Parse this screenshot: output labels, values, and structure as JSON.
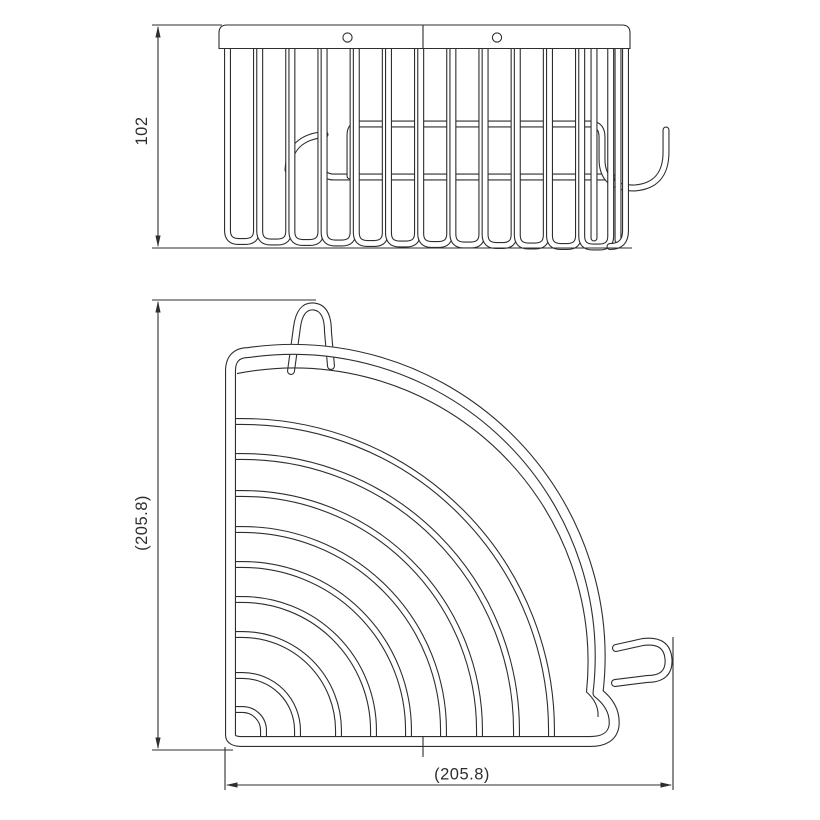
{
  "page": {
    "background_color": "#ffffff",
    "line_color": "#2e2e2e"
  },
  "views": {
    "front_elevation": {
      "dimensions": {
        "height": {
          "label": "102",
          "orientation": "vertical"
        }
      }
    },
    "plan": {
      "dimensions": {
        "depth": {
          "label": "(205.8)",
          "orientation": "vertical"
        },
        "width": {
          "label": "(205.8)",
          "orientation": "horizontal"
        }
      }
    }
  }
}
